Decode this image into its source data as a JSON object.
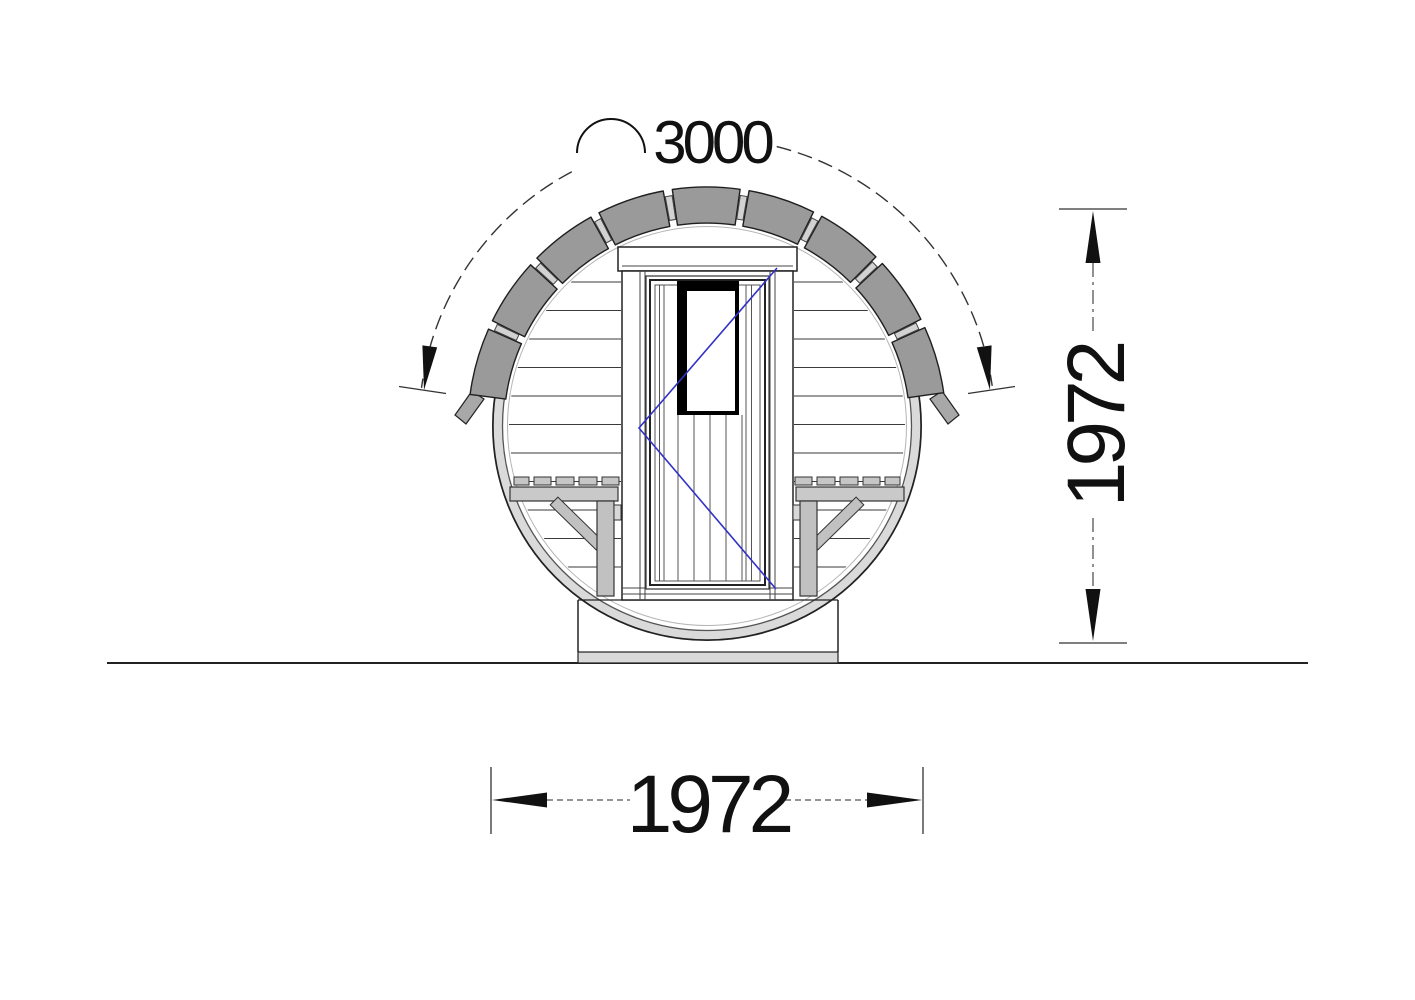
{
  "dimensions": {
    "roof_arc_length": {
      "value": "3000"
    },
    "height": {
      "value": "1972"
    },
    "width": {
      "value": "1972"
    }
  },
  "colors": {
    "shingle_gray": "#9a9a9a",
    "shingle_spacer": "#d2d2d2",
    "rim_gray": "#dadada",
    "bench_gray": "#c6c6c6",
    "bench_fascia": "#c9c9c9",
    "bench_leg": "#c1c1c1",
    "window_black": "#000000",
    "glazing_blue": "#3232c8",
    "line_dark": "#1f1f1f",
    "dim_color": "#111111",
    "base_strip": "#d9d9d9"
  }
}
